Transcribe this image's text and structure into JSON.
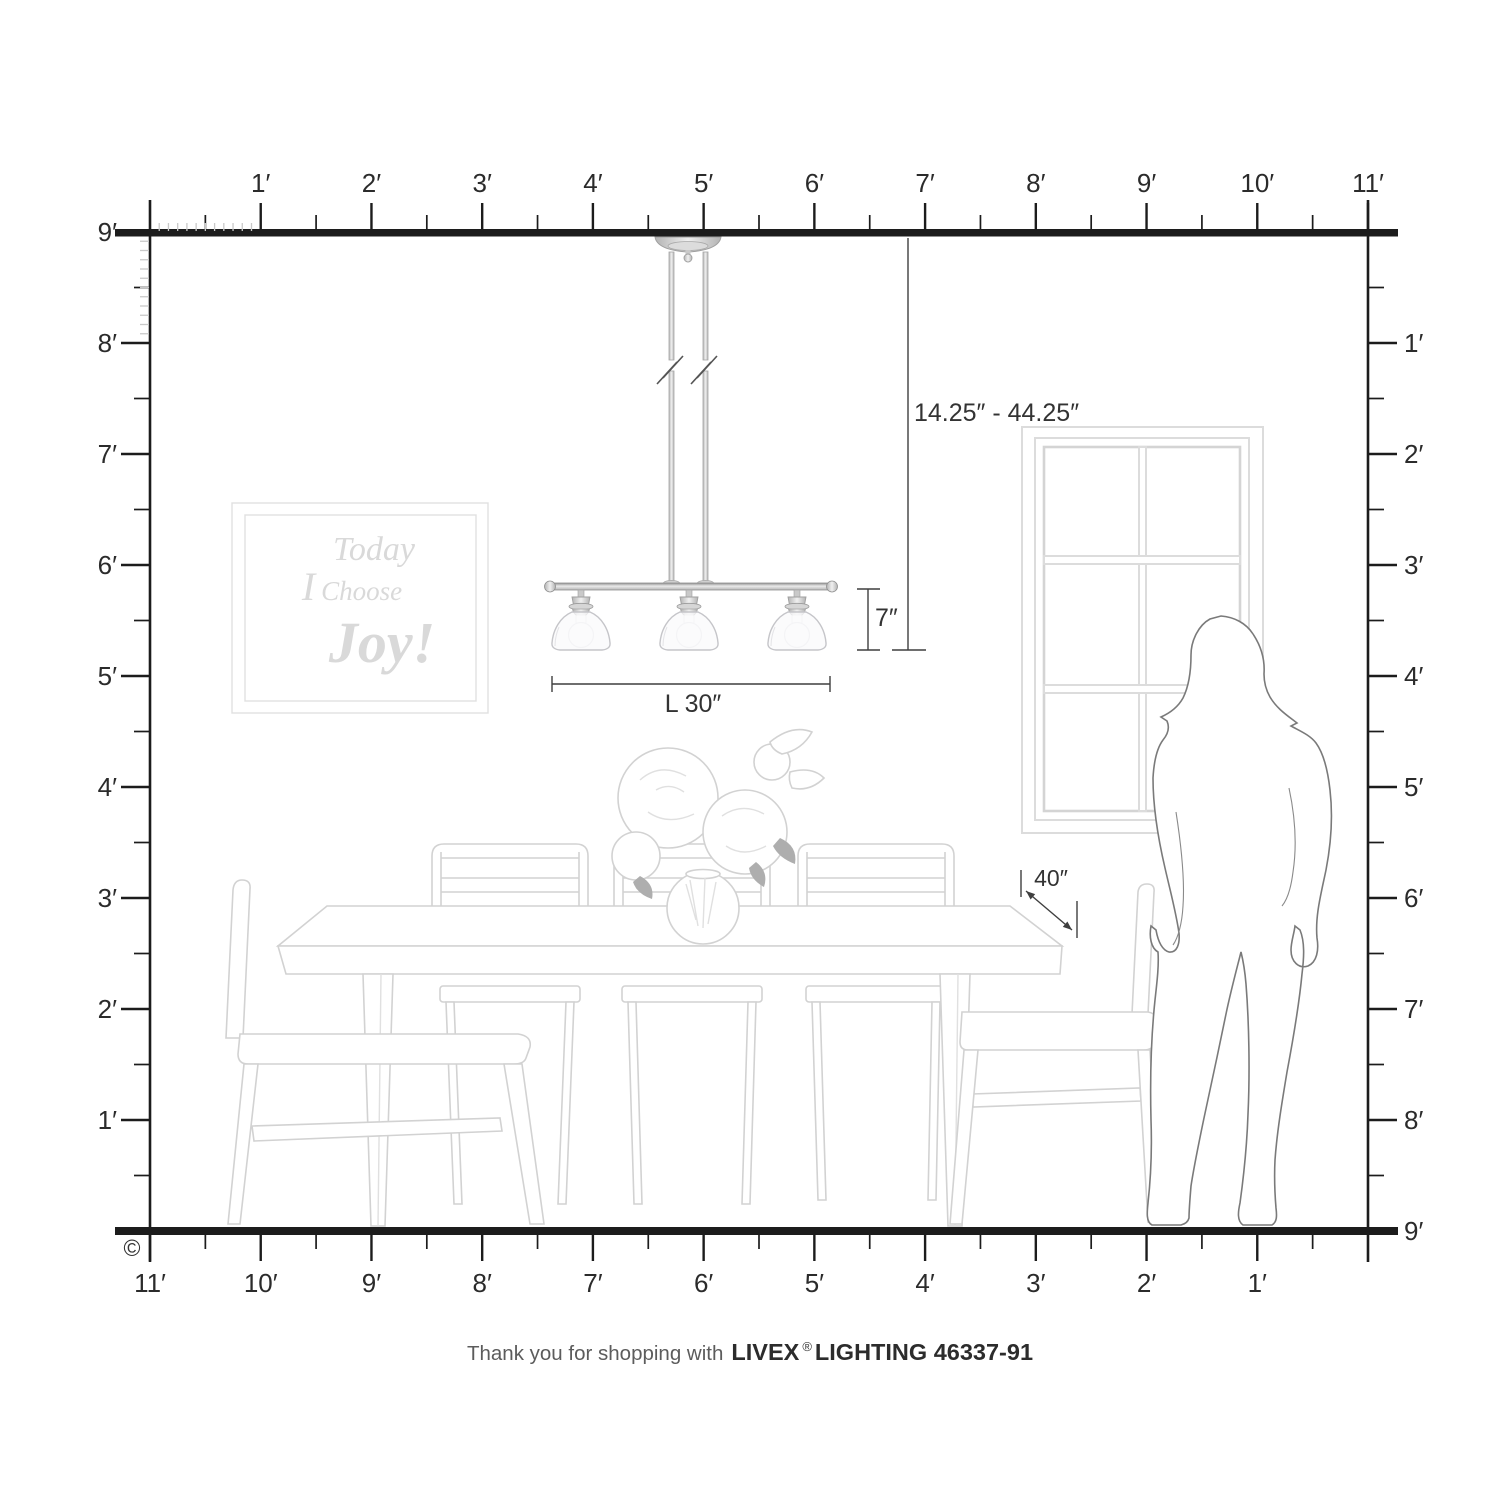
{
  "rulers": {
    "unit": "feet",
    "top": [
      "1′",
      "2′",
      "3′",
      "4′",
      "5′",
      "6′",
      "7′",
      "8′",
      "9′",
      "10′",
      "11′"
    ],
    "bottom": [
      "11′",
      "10′",
      "9′",
      "8′",
      "7′",
      "6′",
      "5′",
      "4′",
      "3′",
      "2′",
      "1′"
    ],
    "left": [
      "9′",
      "8′",
      "7′",
      "6′",
      "5′",
      "4′",
      "3′",
      "2′",
      "1′"
    ],
    "right": [
      "1′",
      "2′",
      "3′",
      "4′",
      "5′",
      "6′",
      "7′",
      "8′",
      "9′"
    ]
  },
  "annotations": {
    "suspension_range": "14.25″ - 44.25″",
    "shade_height": "7″",
    "fixture_length": "L 30″",
    "table_clearance": "40″"
  },
  "wall_art": {
    "line1": "Today",
    "line2_a": "I",
    "line2_b": "Choose",
    "line3": "Joy!"
  },
  "footer": {
    "copyright": "©",
    "thanks": "Thank you for shopping with",
    "brand": "LIVEX",
    "registered": "®",
    "model": "LIGHTING 46337-91"
  },
  "colors": {
    "ink": "#1c1c1c",
    "annotation": "#3f3f3f",
    "furniture_line": "#d2d2d2",
    "silhouette_line": "#7a7a7a",
    "inch_tick": "#c9c9c9",
    "art_text": "#d9d9d9",
    "metal_dark": "#9a9a9a",
    "metal_light": "#eeeeee"
  }
}
